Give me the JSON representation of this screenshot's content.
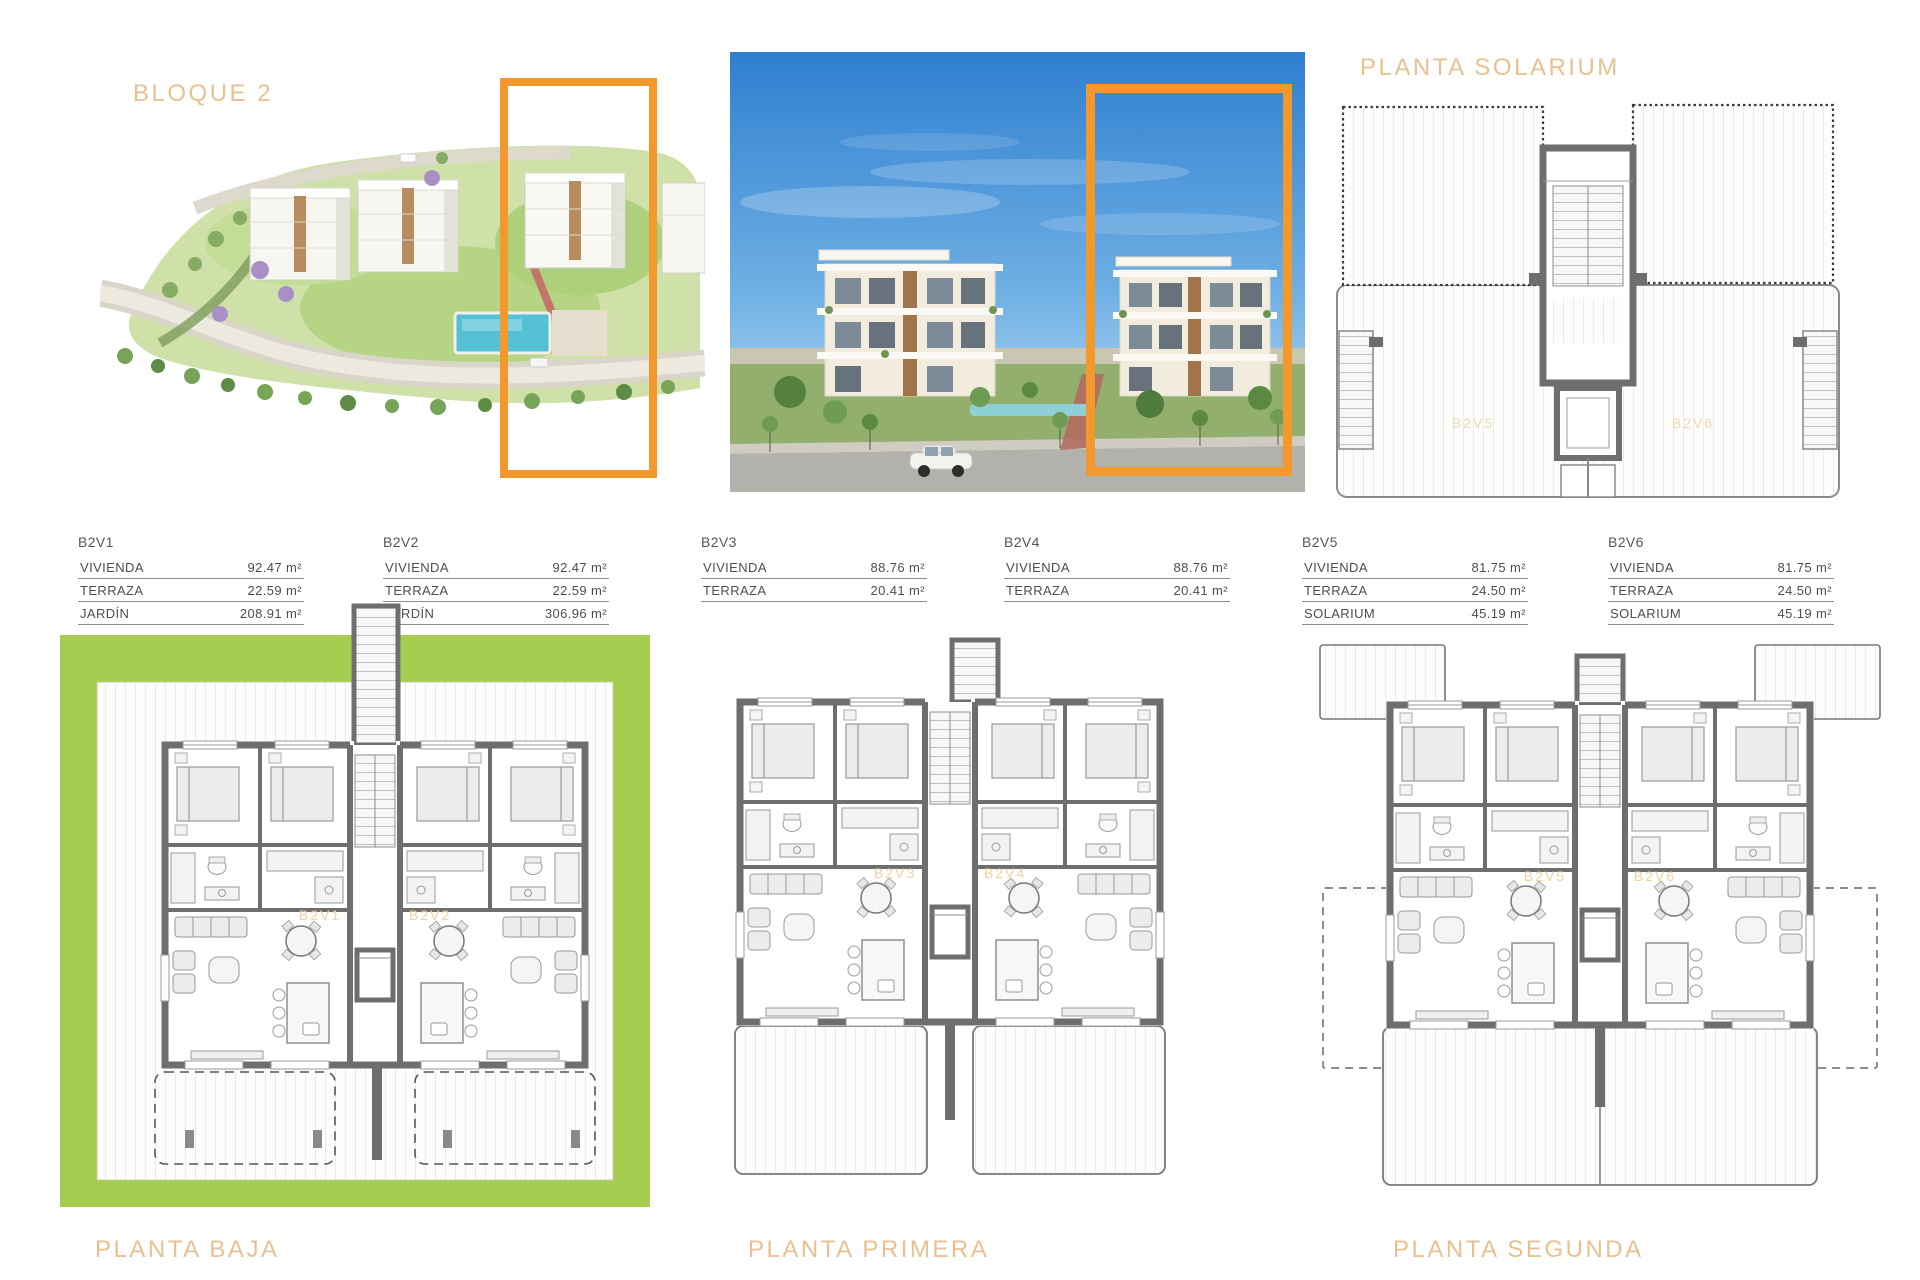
{
  "headings": {
    "bloque": "BLOQUE 2",
    "solarium_plan": "PLANTA SOLARIUM",
    "planta_baja": "PLANTA BAJA",
    "planta_primera": "PLANTA PRIMERA",
    "planta_segunda": "PLANTA SEGUNDA"
  },
  "accent_colors": {
    "highlight_orange": "#F2982C",
    "heading_tan": "#E8C191",
    "garden_green": "#A5CD4F",
    "plan_label_orange": "#F2D2A2",
    "wall_gray": "#6E6E6E"
  },
  "units": [
    {
      "id": "B2V1",
      "rows": [
        [
          "VIVIENDA",
          "92.47 m²"
        ],
        [
          "TERRAZA",
          "22.59 m²"
        ],
        [
          "JARDÍN",
          "208.91 m²"
        ]
      ]
    },
    {
      "id": "B2V2",
      "rows": [
        [
          "VIVIENDA",
          "92.47 m²"
        ],
        [
          "TERRAZA",
          "22.59 m²"
        ],
        [
          "JARDÍN",
          "306.96 m²"
        ]
      ]
    },
    {
      "id": "B2V3",
      "rows": [
        [
          "VIVIENDA",
          "88.76 m²"
        ],
        [
          "TERRAZA",
          "20.41 m²"
        ]
      ]
    },
    {
      "id": "B2V4",
      "rows": [
        [
          "VIVIENDA",
          "88.76 m²"
        ],
        [
          "TERRAZA",
          "20.41 m²"
        ]
      ]
    },
    {
      "id": "B2V5",
      "rows": [
        [
          "VIVIENDA",
          "81.75 m²"
        ],
        [
          "TERRAZA",
          "24.50 m²"
        ],
        [
          "SOLARIUM",
          "45.19 m²"
        ]
      ]
    },
    {
      "id": "B2V6",
      "rows": [
        [
          "VIVIENDA",
          "81.75 m²"
        ],
        [
          "TERRAZA",
          "24.50 m²"
        ],
        [
          "SOLARIUM",
          "45.19 m²"
        ]
      ]
    }
  ],
  "plan_labels": {
    "solarium": [
      "B2V5",
      "B2V6"
    ],
    "baja": [
      "B2V1",
      "B2V2"
    ],
    "primera": [
      "B2V3",
      "B2V4"
    ],
    "segunda": [
      "B2V5",
      "B2V6"
    ]
  }
}
